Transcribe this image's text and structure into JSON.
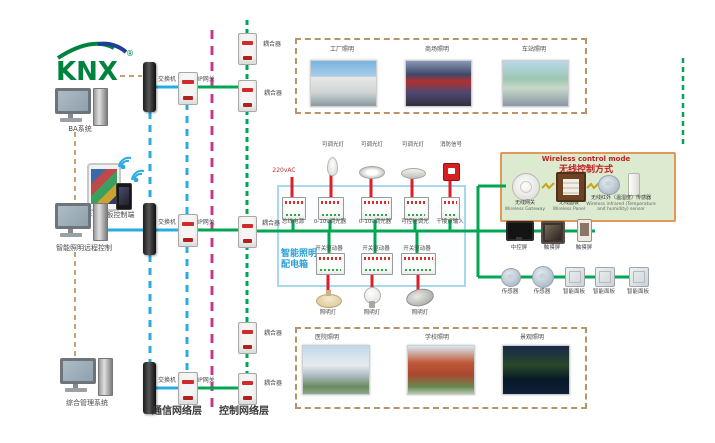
{
  "logo": {
    "text": "KNX",
    "registered": "®"
  },
  "left": {
    "computer1_label": "BA系统",
    "mobile_label": "手机平板控制端",
    "computer2_label": "智能照明远程控制",
    "computer3_label": "综合管理系统"
  },
  "network": {
    "switch_label": "交换机",
    "gateway_label": "IP网关",
    "coupler_label": "耦合器",
    "comm_layer_label": "通信网络层",
    "control_layer_label": "控制网络层"
  },
  "top_box": {
    "items": [
      {
        "label": "工厂照明"
      },
      {
        "label": "商场照明"
      },
      {
        "label": "车站照明"
      }
    ]
  },
  "bottom_box": {
    "items": [
      {
        "label": "医院照明"
      },
      {
        "label": "学校照明"
      },
      {
        "label": "景观照明"
      }
    ]
  },
  "dist_box": {
    "title_line1": "智能照明",
    "title_line2": "配电箱",
    "power_label": "220vAC",
    "top_devices": [
      "可调光灯",
      "可调光灯",
      "可调光灯",
      "消防信号"
    ],
    "row1_modules": [
      "总线电源",
      "0-10v调光器",
      "0-10v调光器",
      "可控硅调光",
      "干接点输入"
    ],
    "row2_modules": [
      "开关驱动器",
      "开关驱动器",
      "开关驱动器"
    ],
    "lamps": [
      "照明灯",
      "照明灯",
      "照明灯"
    ]
  },
  "wireless_box": {
    "title_en": "Wireless control mode",
    "title_cn": "无线控制方式",
    "items": [
      {
        "cn": "无线网关",
        "en": "Wireless Gateway"
      },
      {
        "cn": "无线面板",
        "en": "Wireless Panel"
      },
      {
        "cn": "无线红外（温湿度）传感器",
        "en": "Wireless infrared (Temperature and humidity) sensor"
      }
    ]
  },
  "right_devices": {
    "row1": [
      "中控屏",
      "触摸屏",
      "触摸屏"
    ],
    "row2": [
      "传感器",
      "传感器",
      "智能面板",
      "智能面板",
      "智能面板"
    ]
  },
  "colors": {
    "comm_line": "#29abe2",
    "bus_line": "#00a651",
    "power_line": "#e01e24",
    "control_layer_line": "#bf3d8e",
    "group_dash": "#b89468",
    "dist_border": "#a6d9f0",
    "wireless_bg": "#dcead0",
    "wireless_border": "#e09858",
    "logo_green": "#00833e",
    "logo_blue": "#1d3f94"
  }
}
